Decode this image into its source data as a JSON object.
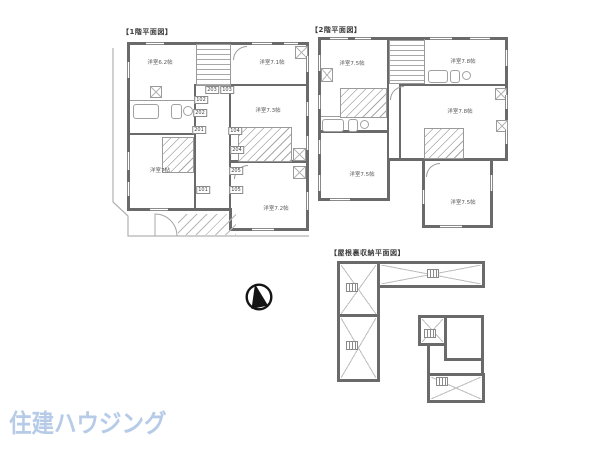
{
  "titles": {
    "floor1": "【1階平面図】",
    "floor2": "【2階平面図】",
    "attic": "【屋根裏収納平面図】"
  },
  "floor1": {
    "rooms": [
      "洋室6.2帖",
      "洋室7.1帖",
      "洋室7.3帖",
      "洋室7帖",
      "洋室7.2帖"
    ],
    "units": [
      "203",
      "103",
      "102",
      "202",
      "201",
      "101",
      "104",
      "204",
      "205",
      "105"
    ]
  },
  "floor2": {
    "rooms": [
      "洋室7.5帖",
      "洋室7.8帖",
      "洋室7.8帖",
      "洋室7.5帖",
      "洋室7.5帖"
    ]
  },
  "icons": {
    "compass": "north-arrow",
    "ladder": "attic-ladder"
  },
  "logo": {
    "text": "住建ハウジング",
    "color": "#b6cbe8"
  },
  "colors": {
    "wall": "#6a6a6a",
    "thin_line": "#b0b0b0",
    "label_text": "#5a5a5a",
    "title_text": "#3a3a3a"
  }
}
